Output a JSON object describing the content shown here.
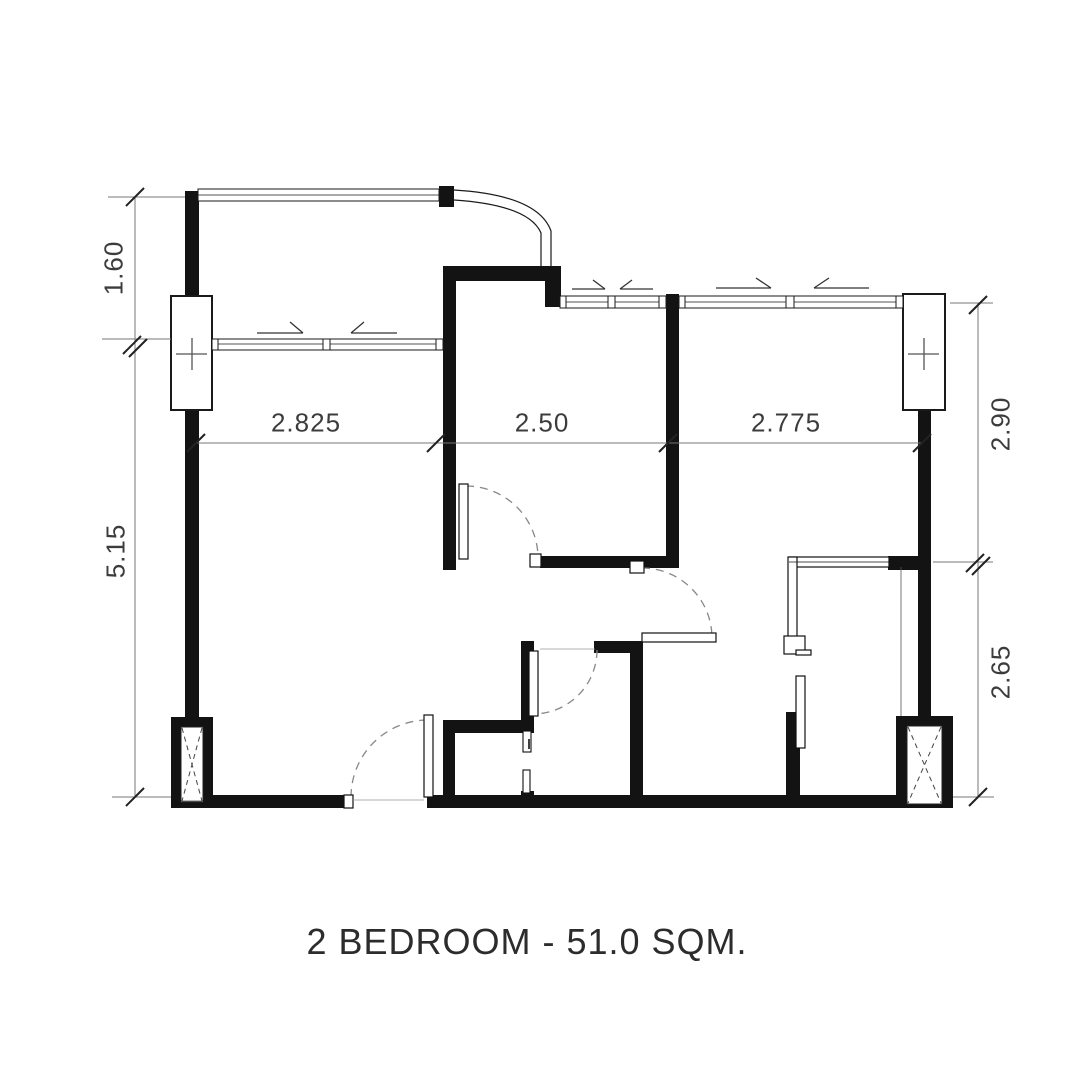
{
  "title": "2 BEDROOM - 51.0 SQM.",
  "plan_summary": {
    "bedrooms": "2",
    "area": "51.0",
    "area_unit": "SQM."
  },
  "dimensions": {
    "left_top": {
      "label": "1.60",
      "value": 1.6,
      "orientation": "vertical",
      "side": "left"
    },
    "left_bottom": {
      "label": "5.15",
      "value": 5.15,
      "orientation": "vertical",
      "side": "left"
    },
    "middle_left": {
      "label": "2.825",
      "value": 2.825,
      "orientation": "horizontal",
      "side": "middle"
    },
    "middle_center": {
      "label": "2.50",
      "value": 2.5,
      "orientation": "horizontal",
      "side": "middle"
    },
    "middle_right": {
      "label": "2.775",
      "value": 2.775,
      "orientation": "horizontal",
      "side": "middle"
    },
    "right_top": {
      "label": "2.90",
      "value": 2.9,
      "orientation": "vertical",
      "side": "right"
    },
    "right_bottom": {
      "label": "2.65",
      "value": 2.65,
      "orientation": "vertical",
      "side": "right"
    }
  },
  "symbols": {
    "column_marker": "plus-cross-icon",
    "shaft_marker": "x-cross-icon",
    "door_swing": "dashed-arc",
    "sliding_window_marker": "half-arrowhead"
  }
}
